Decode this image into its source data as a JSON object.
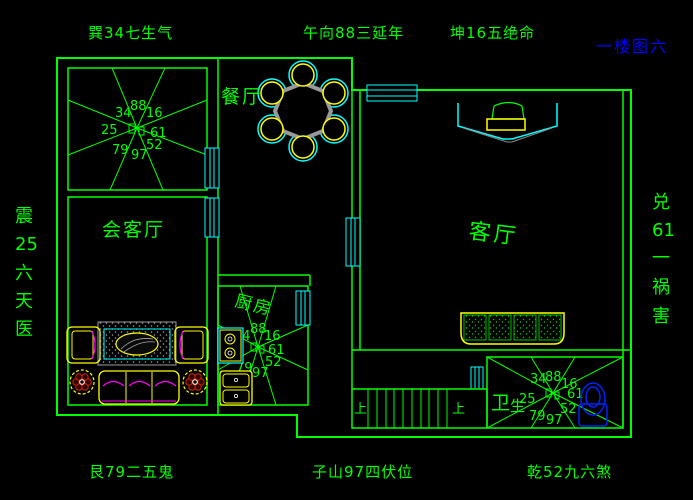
{
  "title": "一楼图六",
  "perimeter_labels": {
    "top_left": "巽34七生气",
    "top_center": "午向88三延年",
    "top_right": "坤16五绝命",
    "bottom_left": "艮79二五鬼",
    "bottom_center": "子山97四伏位",
    "bottom_right": "乾52九六煞",
    "left_chars": [
      "震",
      "25",
      "六",
      "天",
      "医"
    ],
    "right_chars": [
      "兑",
      "61",
      "一",
      "祸",
      "害"
    ]
  },
  "rooms": {
    "dining": "餐厅",
    "reception": "会客厅",
    "living": "客厅",
    "kitchen": "厨房",
    "bathroom_char1": "卫",
    "bathroom_char2": "生"
  },
  "stairs": {
    "up_left": "上",
    "up_right": "上"
  },
  "stars": {
    "numbers": [
      "34",
      "88",
      "16",
      "25",
      "61",
      "79",
      "97",
      "52"
    ]
  },
  "colors": {
    "wall_green": "#00ff00",
    "window_cyan": "#00ffff",
    "furniture_yellow": "#ffff00",
    "accent_magenta": "#ff00ff",
    "fixture_blue": "#0000ff",
    "table_gray": "#999999",
    "background": "#000000"
  }
}
